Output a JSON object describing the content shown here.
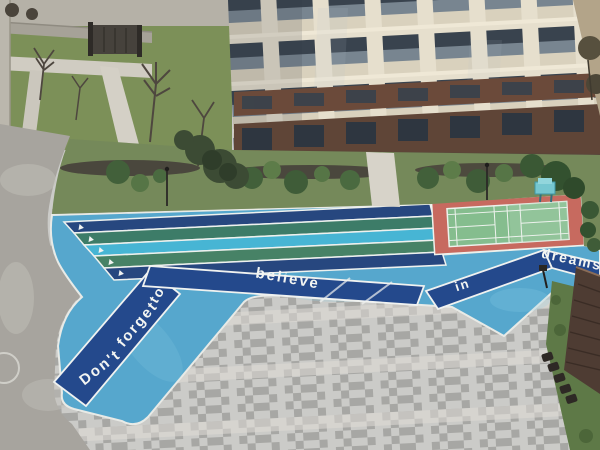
{
  "scene": {
    "description": "Aerial view of a residential compound courtyard with an apartment building, a colorful running track painted with a motivational slogan, a badminton court and a gray paver plaza",
    "setting": "residential compound courtyard, overhead photo"
  },
  "slogan": {
    "full": "Don't forget to believe in dreams",
    "word_dont": "Don't",
    "word_forget": "forget",
    "word_to": "to",
    "word_believe": "believe",
    "word_in": "in",
    "word_dreams": "dreams"
  },
  "track": {
    "field_color": "#56a7cd",
    "ribbon_color": "#24498c",
    "lane_line_color": "#eef1ee",
    "lane_colors": [
      "#27477f",
      "#3d7c68",
      "#47b5d4",
      "#478266",
      "#27477f"
    ]
  },
  "court": {
    "surround_color": "#c76a5f",
    "surface_color": "#85bd8e",
    "line_color": "#edf2ed"
  },
  "palette": {
    "plaza_light": "#cbcbc8",
    "plaza_dark": "#a7a7a4",
    "plaza_band": "#dedad4",
    "road": "#a7a49e",
    "grass": "#7c9058",
    "garden_grass": "#75895a",
    "mulch": "#46403a",
    "building_cream": "#e6dfcd",
    "building_glass": "#39434e",
    "building_brick": "#6b4a3a",
    "building_ground": "#5f4537",
    "roof": "#4e3c33",
    "pavilion_grass": "#5e7947",
    "tan_building": "#b3a489"
  }
}
